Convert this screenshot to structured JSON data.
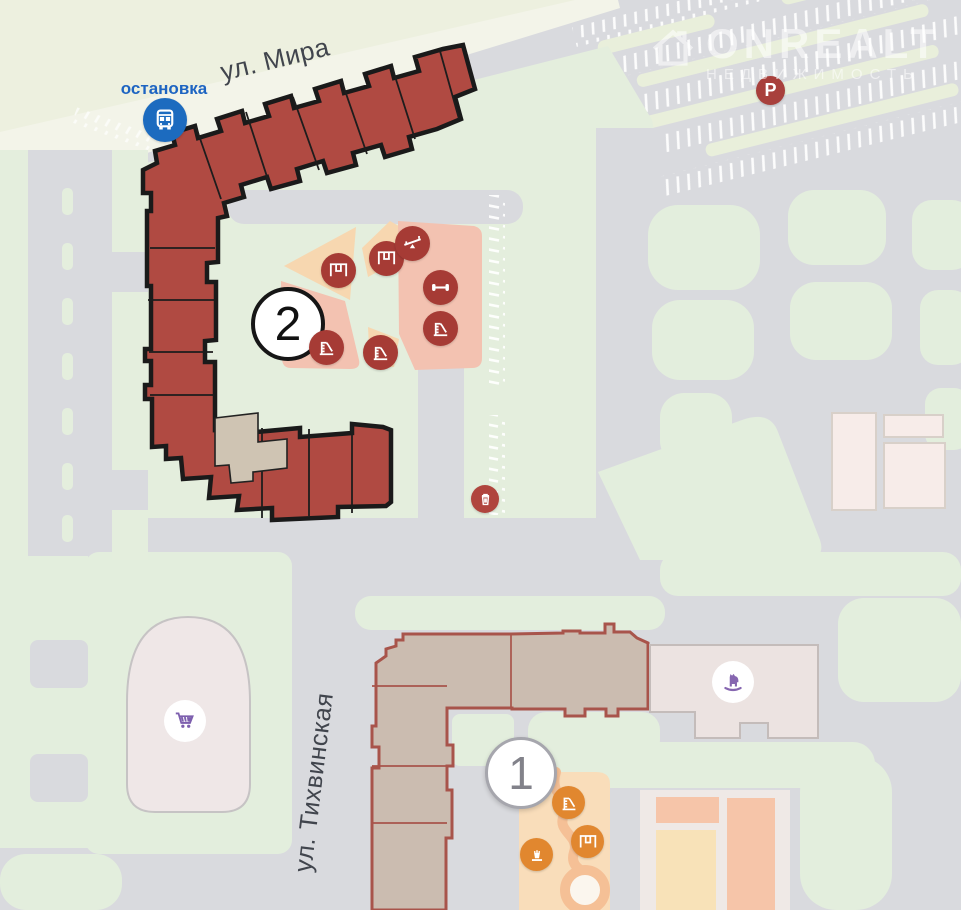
{
  "streets": {
    "mira": "ул. Мира",
    "tikhvinskaya": "ул. Тихвинская"
  },
  "bus_stop": {
    "label": "остановка"
  },
  "markers": {
    "building_2_label": "2",
    "building_1_label": "1",
    "parking_label": "P"
  },
  "watermark": {
    "brand": "ONREALT",
    "subtitle": "НЕДВИЖИМОСТЬ"
  },
  "colors": {
    "building_2_fill": "#b04a42",
    "building_2_outline": "#1a1a1a",
    "building_2_annex": "#cfc4b3",
    "building_1_fill": "#cbbcb0",
    "building_1_outline": "#a8544b",
    "service_building_fill": "#ece3e1",
    "courtyard_green": "#e4eedd",
    "road_gray": "#d9dade",
    "street_cream": "#f3f4e9",
    "playground_peach": "#f7d7b0",
    "playground_pink": "#f3c2b1",
    "amenity_red": "#a63b35",
    "amenity_orange": "#e1872f",
    "amenity_purple": "#7d5fae",
    "bus_blue": "#1c6bbf",
    "parking_red": "#a8403c"
  },
  "amenities": {
    "courtyard_playground": [
      "swing",
      "swing",
      "seesaw",
      "workout",
      "slide",
      "slide",
      "slide"
    ],
    "courtyard_other": [
      "trash-bin"
    ],
    "south_playground": [
      "slide",
      "swing",
      "sandbox"
    ],
    "services": [
      "supermarket",
      "kindergarten"
    ]
  }
}
